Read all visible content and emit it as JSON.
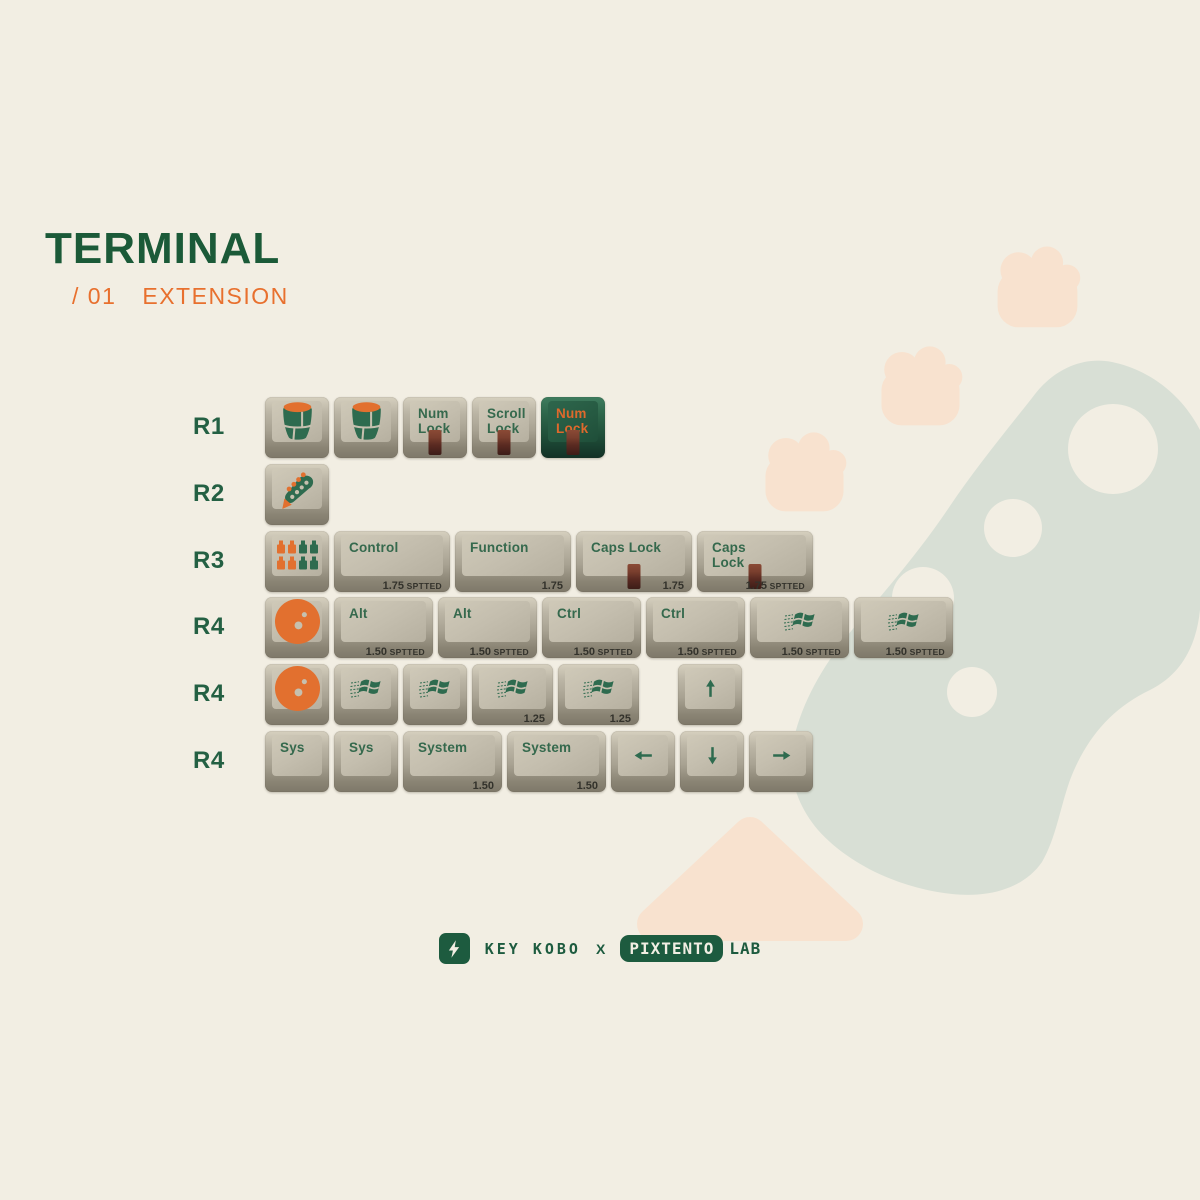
{
  "title_block": {
    "title": "TERMINAL",
    "series_number": "/ 01",
    "series_name": "EXTENSION"
  },
  "palette": {
    "background": "#f2eee3",
    "dark_green": "#1b5a38",
    "legend_green": "#35694d",
    "accent_orange": "#e8702e",
    "keycap_face": "#c6c0af",
    "keycap_dark_face": "#265a42",
    "led_maroon": "#5a2a21",
    "sage_decor": "#d8dfd5",
    "peach_decor": "#f8e2cf"
  },
  "keyboard": {
    "rows": [
      {
        "label": "R1",
        "keys": [
          {
            "icon": "drum-icon",
            "w": 1
          },
          {
            "icon": "drum-icon",
            "w": 1
          },
          {
            "lines": [
              "Num",
              "Lock"
            ],
            "led": true,
            "w": 1
          },
          {
            "lines": [
              "Scroll",
              "Lock"
            ],
            "led": true,
            "w": 1
          },
          {
            "lines": [
              "Num",
              "Lock"
            ],
            "led": true,
            "variant": "dark",
            "w": 1
          }
        ]
      },
      {
        "label": "R2",
        "keys": [
          {
            "icon": "guitar-headstock-icon",
            "w": 1
          }
        ]
      },
      {
        "label": "R3",
        "keys": [
          {
            "icon": "mixer-faders-icon",
            "w": 1
          },
          {
            "label": "Control",
            "size": "1.75",
            "size_suffix": "SPTTED",
            "w": 1.75
          },
          {
            "label": "Function",
            "size": "1.75",
            "w": 1.75
          },
          {
            "label": "Caps Lock",
            "led": true,
            "size": "1.75",
            "w": 1.75
          },
          {
            "lines": [
              "Caps",
              "Lock"
            ],
            "led": true,
            "size": "1.75",
            "size_suffix": "SPTTED",
            "w": 1.75
          }
        ]
      },
      {
        "label": "R4",
        "keys": [
          {
            "icon": "bowling-ball-icon",
            "w": 1
          },
          {
            "label": "Alt",
            "size": "1.50",
            "size_suffix": "SPTTED",
            "w": 1.5
          },
          {
            "label": "Alt",
            "size": "1.50",
            "size_suffix": "SPTTED",
            "w": 1.5
          },
          {
            "label": "Ctrl",
            "size": "1.50",
            "size_suffix": "SPTTED",
            "w": 1.5
          },
          {
            "label": "Ctrl",
            "size": "1.50",
            "size_suffix": "SPTTED",
            "w": 1.5
          },
          {
            "icon": "windows-logo-icon",
            "size": "1.50",
            "size_suffix": "SPTTED",
            "w": 1.5
          },
          {
            "icon": "windows-logo-icon",
            "size": "1.50",
            "size_suffix": "SPTTED",
            "w": 1.5
          }
        ]
      },
      {
        "label": "R4",
        "keys": [
          {
            "icon": "bowling-ball-icon",
            "w": 1
          },
          {
            "icon": "windows-logo-icon",
            "w": 1
          },
          {
            "icon": "windows-logo-icon",
            "w": 1
          },
          {
            "icon": "windows-logo-icon",
            "size": "1.25",
            "w": 1.25
          },
          {
            "icon": "windows-logo-icon",
            "size": "1.25",
            "w": 1.25
          },
          {
            "icon": "arrow-up-icon",
            "w": 1,
            "gap_before": 34
          }
        ]
      },
      {
        "label": "R4",
        "keys": [
          {
            "label": "Sys",
            "w": 1
          },
          {
            "label": "Sys",
            "w": 1
          },
          {
            "label": "System",
            "size": "1.50",
            "w": 1.5
          },
          {
            "label": "System",
            "size": "1.50",
            "w": 1.5
          },
          {
            "icon": "arrow-left-icon",
            "w": 1
          },
          {
            "icon": "arrow-down-icon",
            "w": 1
          },
          {
            "icon": "arrow-right-icon",
            "w": 1
          }
        ]
      }
    ]
  },
  "footer": {
    "logo_icon": "lightning-bolt-icon",
    "brand_left": "KEY KOBO",
    "separator": "X",
    "brand_right": "PIXTENTO",
    "brand_right_suffix": "LAB"
  },
  "decor": {
    "shapes": [
      "bass-headstock-silhouette",
      "paw-print",
      "paw-print",
      "paw-print",
      "pick-triangle"
    ]
  }
}
